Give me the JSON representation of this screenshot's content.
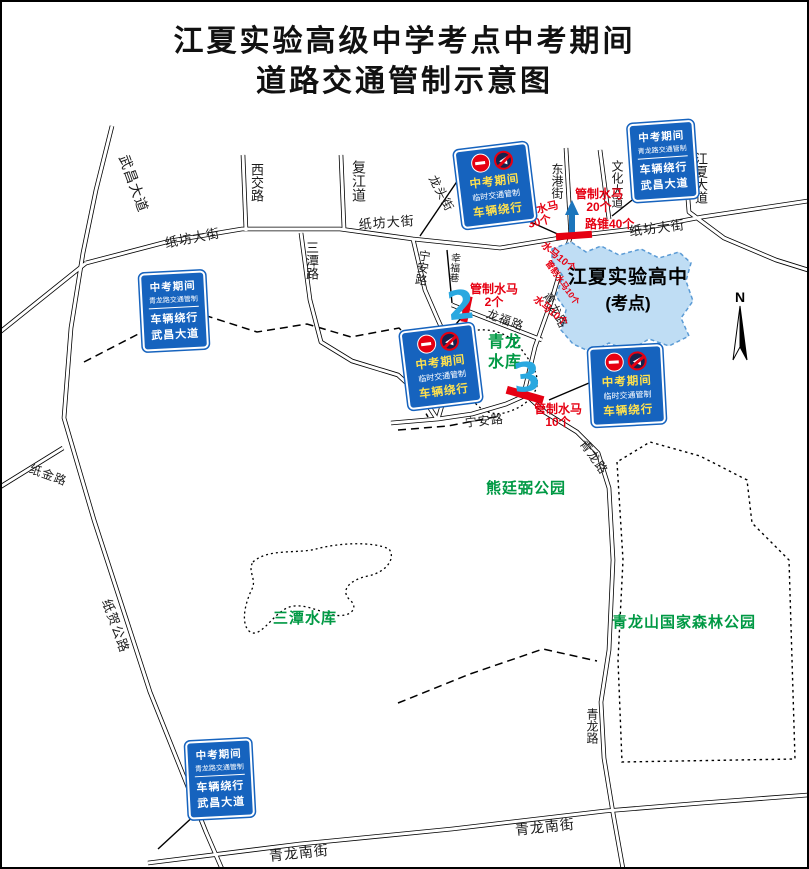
{
  "title": {
    "line1": "江夏实验高级中学考点中考期间",
    "line2": "道路交通管制示意图"
  },
  "signs": {
    "temporary": {
      "period": "中考期间",
      "control": "临时交通管制",
      "detour": "车辆绕行"
    },
    "qinglong": {
      "period": "中考期间",
      "control": "青龙路交通管制",
      "detour": "车辆绕行",
      "via": "武昌大道"
    }
  },
  "sign_icons": [
    "no-entry",
    "no-horn"
  ],
  "annotations": {
    "barrier20": {
      "line1": "管制水马",
      "line2": "20个"
    },
    "barrier30": {
      "line1": "管制水马",
      "line2": "30个"
    },
    "cones40": {
      "text": "路锥40个"
    },
    "barrier2": {
      "line1": "管制水马",
      "line2": "2个"
    },
    "barrier10": {
      "line1": "管制水马",
      "line2": "10个"
    },
    "roadside_a": {
      "text": "水马10个"
    },
    "roadside_mid": {
      "text": "管制水马10个"
    },
    "roadside_b": {
      "text": "水马10个"
    }
  },
  "school": {
    "name": "江夏实验高中",
    "sub": "(考点)"
  },
  "areas": {
    "qinglong_reservoir": "青龙水库",
    "xiongtingbi_park": "熊廷弼公园",
    "santan_reservoir": "三潭水库",
    "qinglongshan_park": "青龙山国家森林公园"
  },
  "road_labels": [
    {
      "text": "武昌大道"
    },
    {
      "text": "西交路"
    },
    {
      "text": "复江道"
    },
    {
      "text": "龙头街"
    },
    {
      "text": "纸坊大街"
    },
    {
      "text": "纸坊大街"
    },
    {
      "text": "纸坊大街"
    },
    {
      "text": "东港街"
    },
    {
      "text": "文化大道"
    },
    {
      "text": "江夏大道"
    },
    {
      "text": "三潭路"
    },
    {
      "text": "宁安路"
    },
    {
      "text": "幸福巷"
    },
    {
      "text": "龙福路"
    },
    {
      "text": "青龙路"
    },
    {
      "text": "宁安路"
    },
    {
      "text": "青龙路"
    },
    {
      "text": "青龙路"
    },
    {
      "text": "青龙南街"
    },
    {
      "text": "青龙南街"
    },
    {
      "text": "纸金路"
    },
    {
      "text": "纸贺公路"
    }
  ],
  "markers": {
    "point2": "2",
    "point3": "3"
  },
  "compass": {
    "north": "N"
  },
  "colors": {
    "sign_blue": "#1663be",
    "control_red": "#e60012",
    "area_green": "#009944",
    "marker_blue": "#29a8e0",
    "school_fill": "#bfddf4",
    "school_border": "#5b9bd5",
    "arrow_blue": "#1b75bc"
  }
}
